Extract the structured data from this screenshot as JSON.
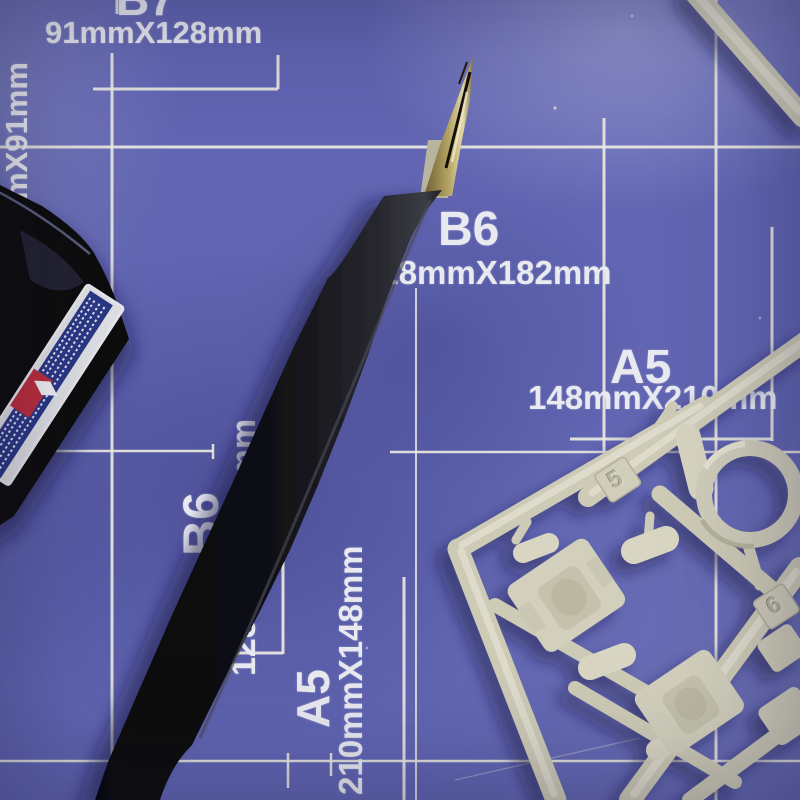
{
  "mat": {
    "color_base": "#6165b2",
    "grid_color": "#e8e8e0",
    "labels": [
      {
        "id": "b7-top",
        "size": "B7",
        "dims": "91mmX128mm"
      },
      {
        "id": "b8-left",
        "size": "",
        "dims": "64mmX91mm"
      },
      {
        "id": "b6-center",
        "size": "B6",
        "dims": "128mmX182mm"
      },
      {
        "id": "b6-left",
        "size": "B6",
        "dims": "128mmX182mm"
      },
      {
        "id": "a5-right",
        "size": "A5",
        "dims": "148mmX210mm"
      },
      {
        "id": "a5-bottom",
        "size": "A5",
        "dims": "210mmX148mm"
      }
    ]
  },
  "objects": {
    "paint_bottle": {
      "body_color": "#0b0b10",
      "label_navy": "#2c3786",
      "label_red": "#bb2f3e",
      "label_edge": "#d9dade"
    },
    "pen": {
      "body_color": "#121217",
      "nib_gold": "#b3a365",
      "nib_silver": "#b8b49e"
    },
    "sprue": {
      "plastic_color": "#cdcab6",
      "tags": [
        {
          "number": "5"
        },
        {
          "number": "6"
        }
      ]
    }
  }
}
